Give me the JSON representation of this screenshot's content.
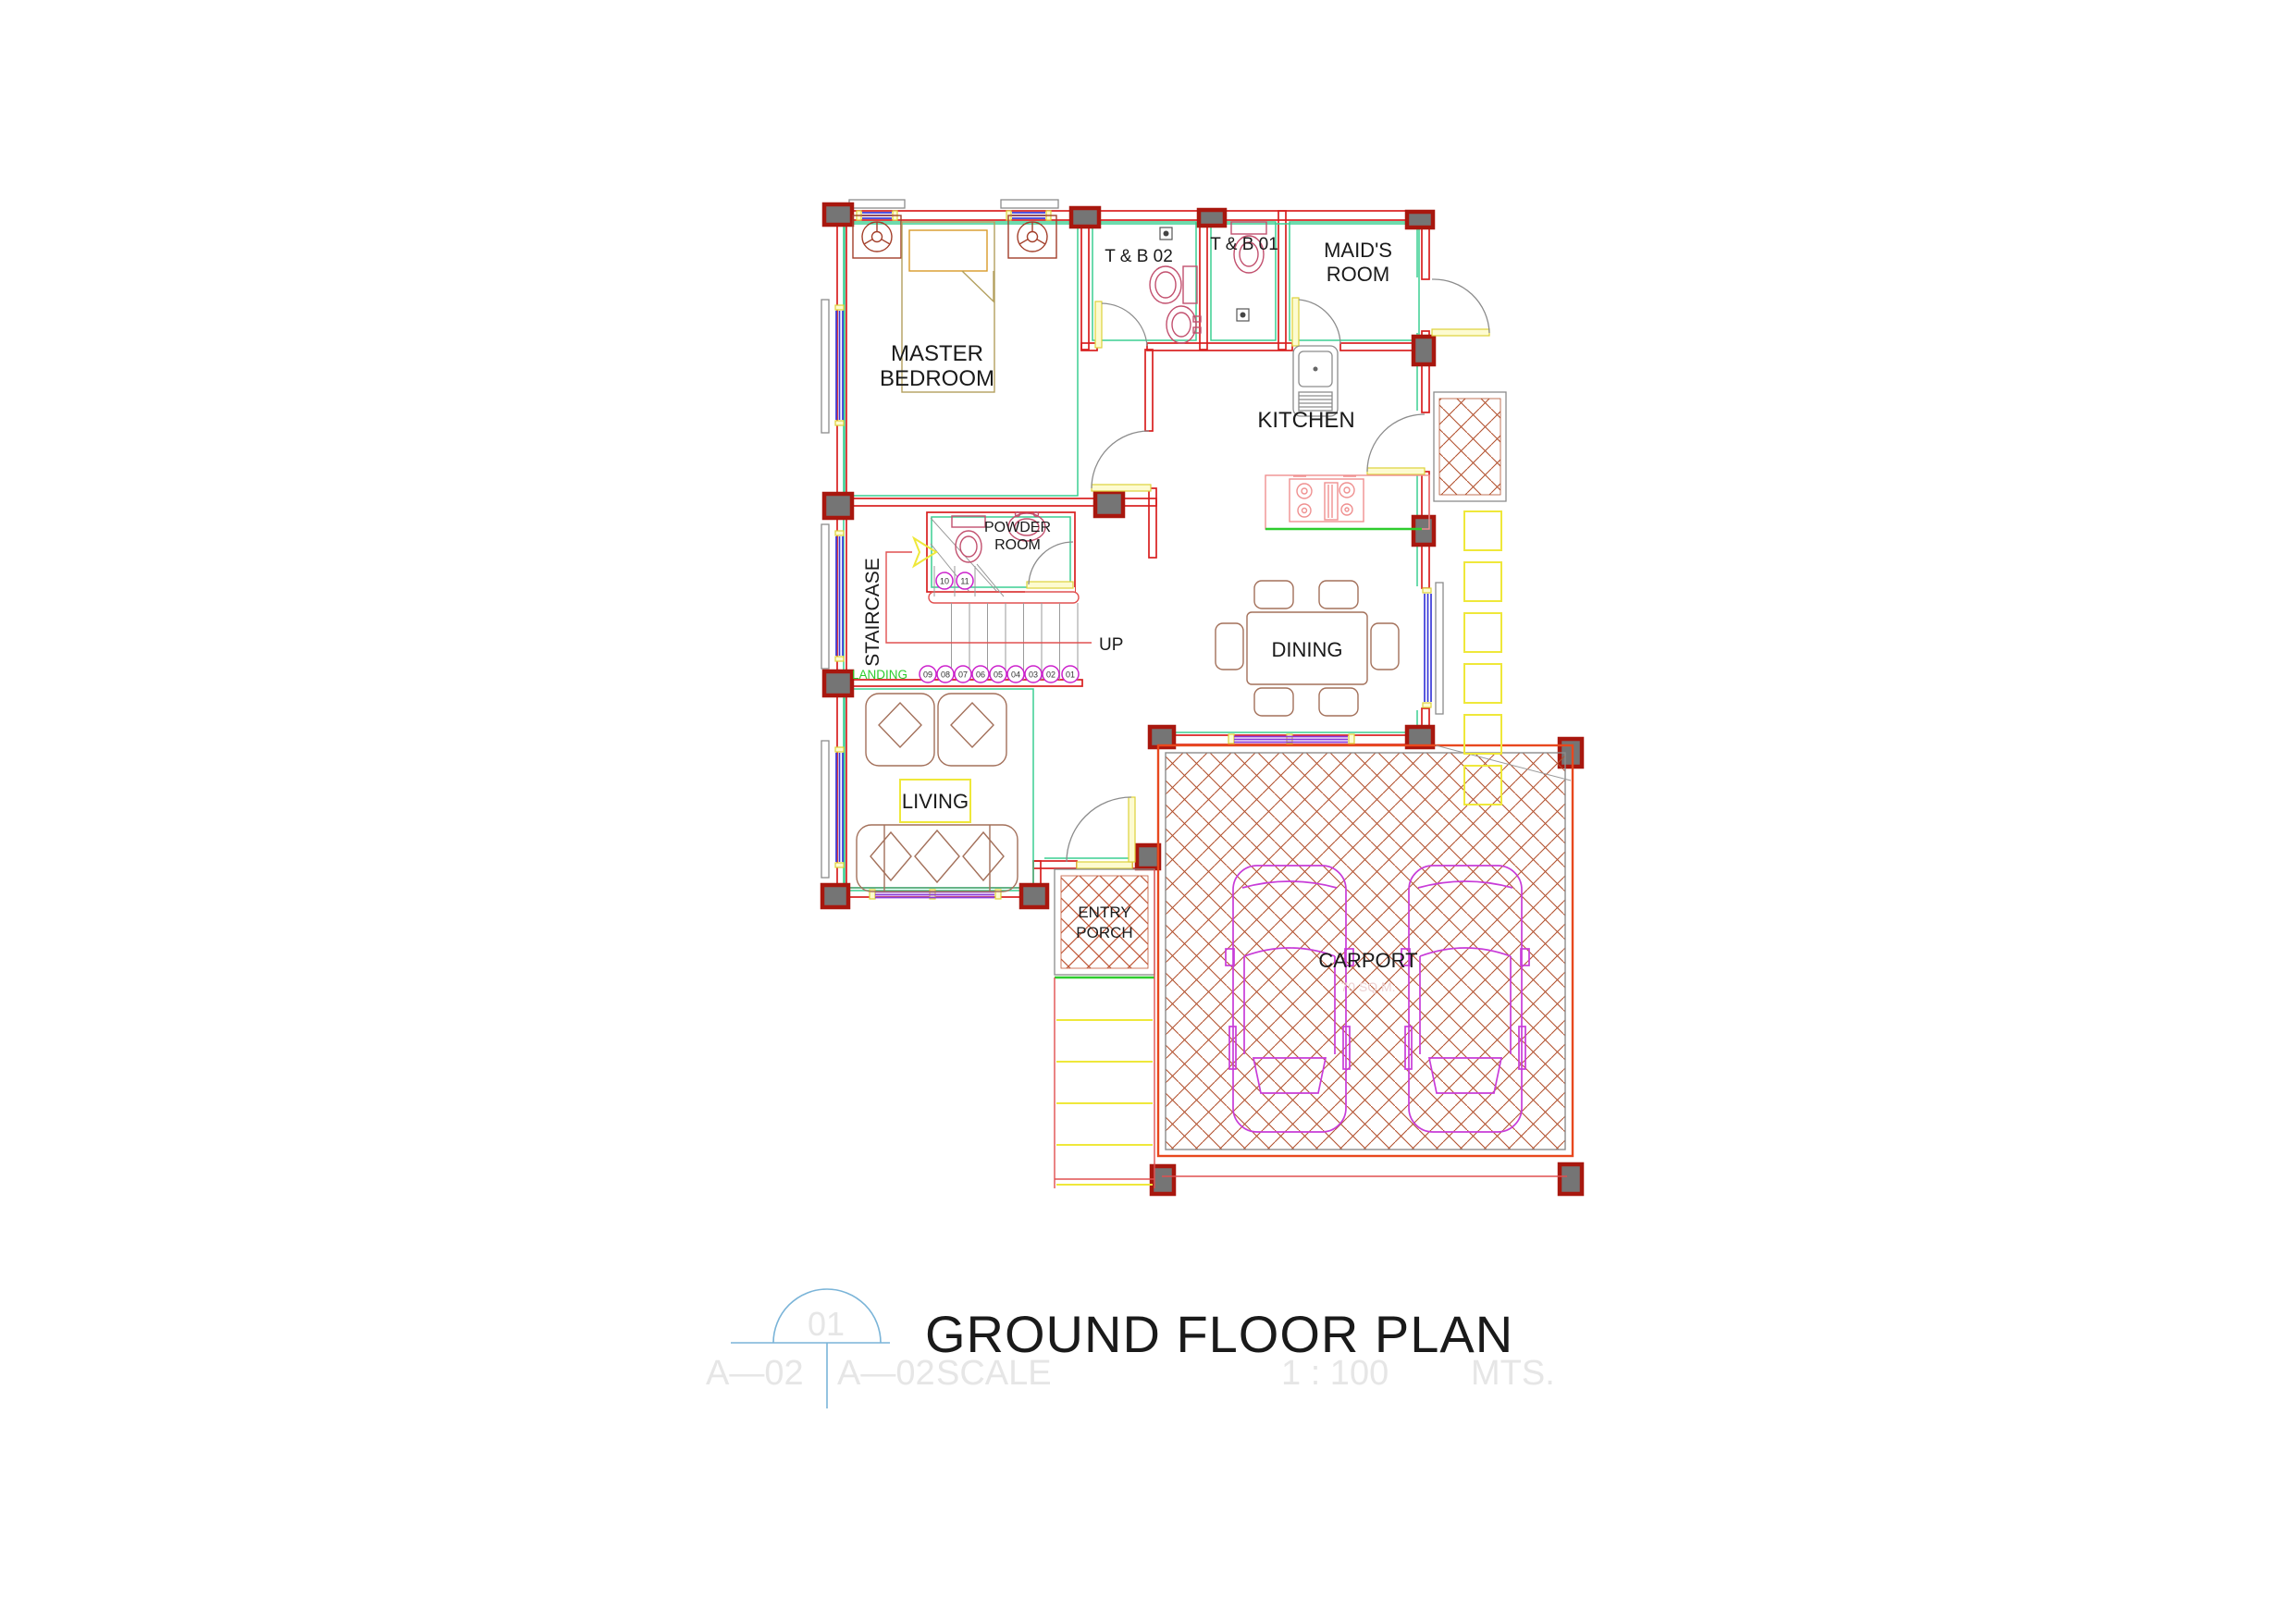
{
  "title_block": {
    "title": "GROUND FLOOR PLAN",
    "detail_bubble": "01",
    "sheet_ref_a": "A—02",
    "sheet_ref_b": "A—02",
    "scale_label": "SCALE",
    "scale_value": "1 : 100",
    "scale_unit": "MTS."
  },
  "rooms": {
    "master_bedroom": {
      "line1": "MASTER",
      "line2": "BEDROOM"
    },
    "tb02": "T & B 02",
    "tb01": "T & B 01",
    "maids_room": {
      "line1": "MAID'S",
      "line2": "ROOM"
    },
    "kitchen": "KITCHEN",
    "powder_room": {
      "line1": "POWDER",
      "line2": "ROOM"
    },
    "staircase": "STAIRCASE",
    "landing": "LANDING",
    "up": "UP",
    "dining": "DINING",
    "living": "LIVING",
    "entry_porch": {
      "line1": "ENTRY",
      "line2": "PORCH"
    },
    "carport": "CARPORT",
    "carport_area_note": "70 SQ.M."
  },
  "stairs": {
    "steps": [
      "01",
      "02",
      "03",
      "04",
      "05",
      "06",
      "07",
      "08",
      "09",
      "10",
      "11"
    ]
  },
  "colors": {
    "wall_red": "#d81f1f",
    "accent_green": "#3bcf92",
    "bright_green": "#2ecc2e",
    "sill_yellow": "#efe83a",
    "window_blue": "#3a3ad8",
    "window_purple": "#8a3ad8",
    "column_gray": "#757575",
    "column_border": "#a8170e",
    "furniture_brown": "#a3705a",
    "fixture_pink": "#c2506e",
    "stove_pink": "#ef9090",
    "brick_brown": "#b2512e",
    "porch_hatch": "#c05838",
    "car_magenta": "#c83cd8",
    "step_circle_magenta": "#cc22cc",
    "title_symbol_blue": "#7ab4d8",
    "faint_gray": "#e6e6e6"
  }
}
